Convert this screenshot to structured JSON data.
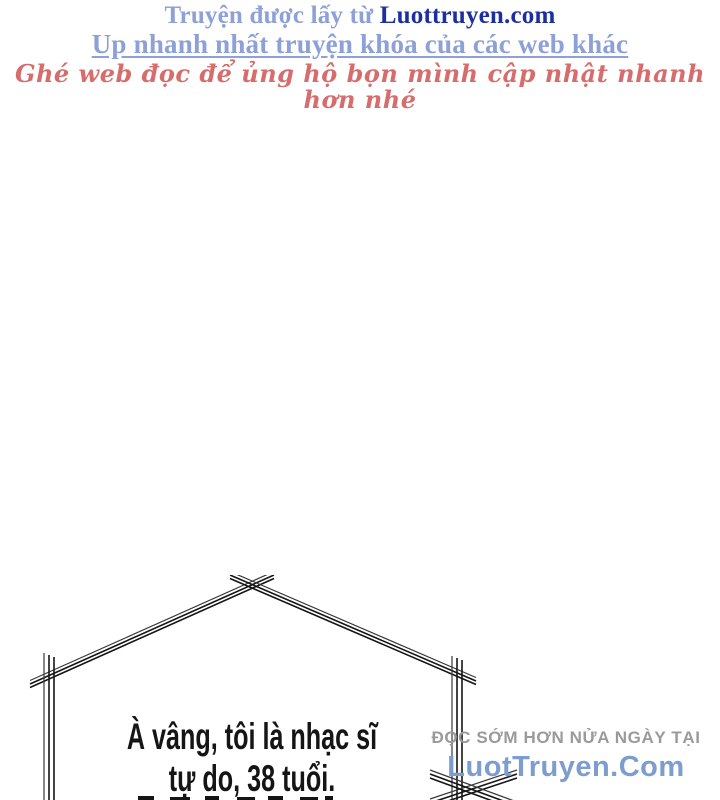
{
  "header": {
    "line1_light": "Truyện được lấy từ ",
    "line1_brand": "Luottruyen.com",
    "line2": "Up nhanh nhất truyện khóa của các web khác",
    "line3": "Ghé web đọc để ủng hộ bọn mình cập nhật nhanh hơn nhé"
  },
  "speech_bubble": {
    "line1": "À vâng, tôi là nhạc sĩ",
    "line2": "tự do, 38 tuổi."
  },
  "watermark": {
    "line1": "ĐỌC SỚM HƠN NỬA NGÀY TẠI",
    "line2": "LuotTruyen.Com"
  },
  "colors": {
    "header_light_blue": "#8DA0D8",
    "header_brand_blue": "#1D2F9F",
    "header_red": "#D66C6C",
    "watermark_gray": "#9A9A9A",
    "watermark_blue": "#7C9DCE",
    "ink": "#151515"
  }
}
